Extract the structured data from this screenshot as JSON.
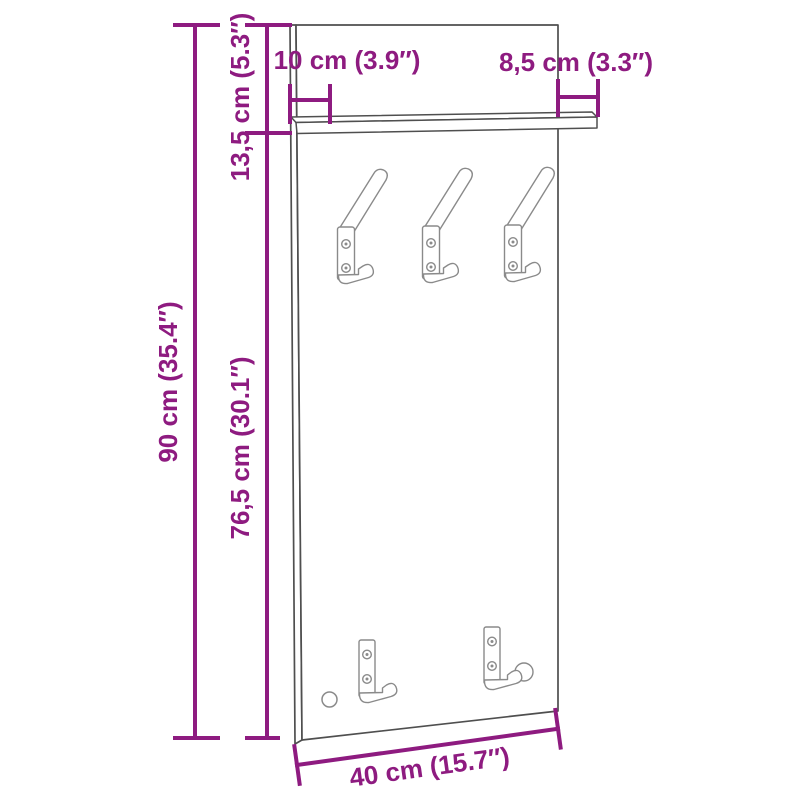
{
  "diagram": {
    "subject": "wall-mounted coat rack panel with top shelf, three upper coat hooks and two lower hooks",
    "colors": {
      "dimension": "#8e1b80",
      "outline": "#4f4f4f",
      "hook_outline": "#8a8a8a",
      "background": "#ffffff"
    },
    "dimensions": {
      "total_height": "90 cm (35.4″)",
      "shelf_section_height": "13,5 cm (5.3″)",
      "lower_section_height": "76,5 cm (30.1″)",
      "shelf_depth_left": "10 cm (3.9″)",
      "shelf_depth_right": "8,5 cm (3.3″)",
      "total_width": "40 cm (15.7″)"
    },
    "counts": {
      "upper_hooks": 3,
      "lower_hooks": 2
    }
  }
}
